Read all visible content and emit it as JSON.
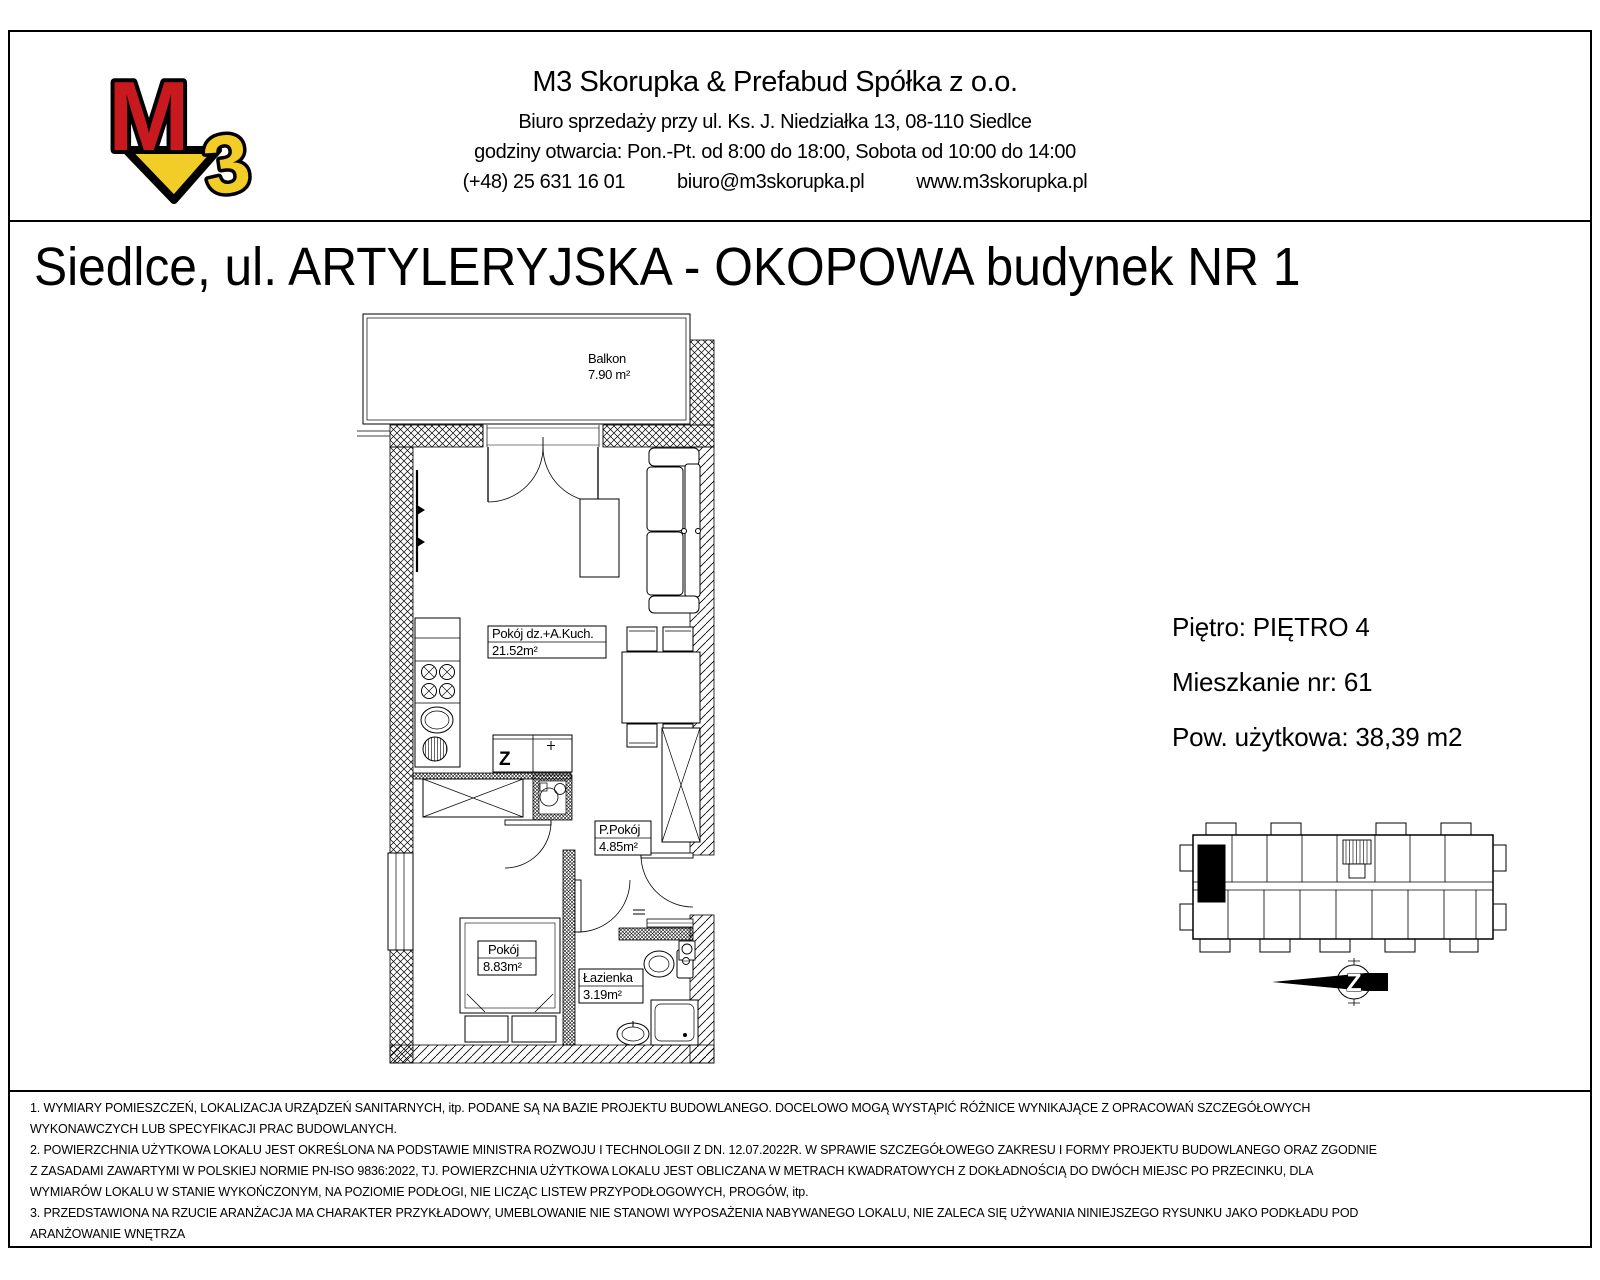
{
  "header": {
    "company": "M3 Skorupka & Prefabud Spółka z o.o.",
    "address": "Biuro sprzedaży przy ul. Ks. J. Niedziałka 13, 08-110 Siedlce",
    "hours": "godziny otwarcia: Pon.-Pt. od 8:00 do 18:00, Sobota od 10:00 do 14:00",
    "phone": "(+48) 25 631 16 01",
    "email": "biuro@m3skorupka.pl",
    "website": "www.m3skorupka.pl",
    "logo": {
      "letter_m": "M",
      "digit_3": "3",
      "color_m": "#c8191e",
      "color_3": "#f3cd27",
      "outline": "#000000"
    }
  },
  "title": "Siedlce, ul. ARTYLERYJSKA - OKOPOWA budynek NR 1",
  "apartment": {
    "floor": "Piętro: PIĘTRO 4",
    "number": "Mieszkanie nr: 61",
    "area": "Pow. użytkowa: 38,39 m2"
  },
  "plan": {
    "balcony": {
      "name": "Balkon",
      "area": "7.90 m²"
    },
    "living": {
      "name": "Pokój dz.+A.Kuch.",
      "area": "21.52m²"
    },
    "hall": {
      "name": "P.Pokój",
      "area": "4.85m²"
    },
    "bedroom": {
      "name": "Pokój",
      "area": "8.83m²"
    },
    "bathroom": {
      "name": "Łazienka",
      "area": "3.19m²"
    },
    "counter_letter": "Z",
    "compass_letter": "Z"
  },
  "footnotes": [
    "1. WYMIARY POMIESZCZEŃ, LOKALIZACJA URZĄDZEŃ SANITARNYCH, itp. PODANE SĄ NA BAZIE PROJEKTU BUDOWLANEGO. DOCELOWO MOGĄ WYSTĄPIĆ RÓŻNICE  WYNIKAJĄCE Z OPRACOWAŃ SZCZEGÓŁOWYCH",
    "WYKONAWCZYCH LUB SPECYFIKACJI PRAC BUDOWLANYCH.",
    "2. POWIERZCHNIA UŻYTKOWA LOKALU JEST OKREŚLONA NA PODSTAWIE MINISTRA ROZWOJU I TECHNOLOGII Z DN. 12.07.2022R. W SPRAWIE SZCZEGÓŁOWEGO ZAKRESU I FORMY PROJEKTU BUDOWLANEGO ORAZ ZGODNIE",
    "Z ZASADAMI ZAWARTYMI W POLSKIEJ NORMIE PN-ISO 9836:2022, TJ. POWIERZCHNIA UŻYTKOWA LOKALU JEST OBLICZANA W METRACH KWADRATOWYCH Z DOKŁADNOŚCIĄ DO DWÓCH MIEJSC PO PRZECINKU, DLA",
    "WYMIARÓW LOKALU W STANIE WYKOŃCZONYM, NA POZIOMIE PODŁOGI, NIE LICZĄC LISTEW PRZYPODŁOGOWYCH, PROGÓW, itp.",
    "3. PRZEDSTAWIONA NA RZUCIE ARANŻACJA MA CHARAKTER PRZYKŁADOWY, UMEBLOWANIE NIE STANOWI WYPOSAŻENIA NABYWANEGO LOKALU, NIE ZALECA SIĘ UŻYWANIA NINIEJSZEGO RYSUNKU JAKO PODKŁADU POD",
    "ARANŻOWANIE WNĘTRZA"
  ]
}
